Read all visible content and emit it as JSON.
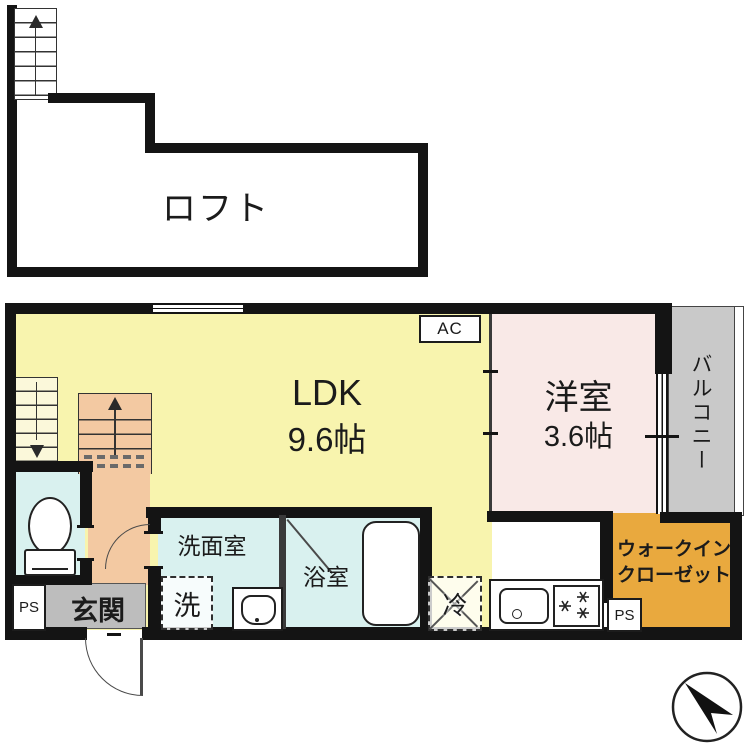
{
  "floorplan": {
    "loft": {
      "label": "ロフト"
    },
    "rooms": {
      "ldk": {
        "name": "LDK",
        "size": "9.6帖"
      },
      "bedroom": {
        "name": "洋室",
        "size": "3.6帖"
      },
      "balcony": {
        "name": "バルコニー"
      },
      "washroom": {
        "name": "洗面室"
      },
      "bathroom": {
        "name": "浴室"
      },
      "entrance": {
        "name": "玄関"
      },
      "walk_in_closet": {
        "line1": "ウォークイン",
        "line2": "クローゼット"
      }
    },
    "fixtures": {
      "ac": "AC",
      "fridge": "冷",
      "washer": "洗",
      "ps_left": "PS",
      "ps_right": "PS"
    },
    "colors": {
      "ldk_yellow": "#f8f4ae",
      "bedroom_pink": "#f9e9e7",
      "balcony_gray": "#c9c9c9",
      "wet_room_blue": "#d9f1ef",
      "stairs_hall_peach": "#f3c9a2",
      "entrance_gray": "#bdbdbd",
      "closet_amber": "#e9a93e",
      "wall_black": "#141414"
    },
    "icons": [
      "stairs-up-icon",
      "stairs-down-icon",
      "toilet-icon",
      "bathtub-icon",
      "washstand-icon",
      "kitchen-sink-icon",
      "stove-icon",
      "door-swing-icon",
      "north-arrow-icon",
      "window-icon"
    ]
  }
}
